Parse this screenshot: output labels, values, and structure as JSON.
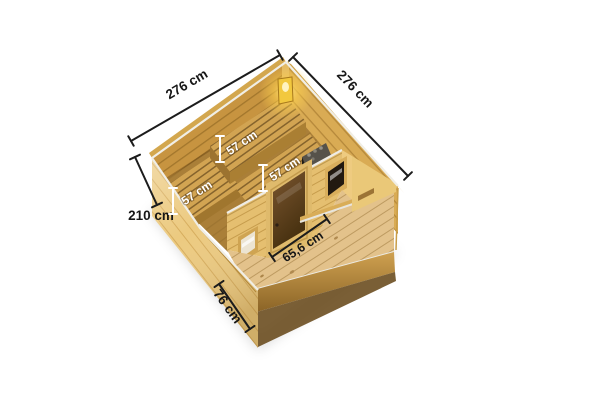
{
  "image": {
    "type": "product-dimension-diagram",
    "subject": "wooden sauna cabin, isometric top view with open roof, measurement annotations"
  },
  "dimensions": {
    "edge_top_left": {
      "label": "276 cm"
    },
    "edge_top_right": {
      "label": "276 cm"
    },
    "wall_height": {
      "label": "210 cm"
    },
    "porch_depth": {
      "label": "76 cm"
    },
    "door_width": {
      "label": "65,6 cm"
    },
    "bench_back": {
      "label": "57 cm"
    },
    "bench_middle": {
      "label": "57 cm"
    },
    "bench_front": {
      "label": "57 cm"
    }
  },
  "colors": {
    "background": "#ffffff",
    "wood_exterior": "#ecca80",
    "wood_interior_wall": "#c79440",
    "wood_bench_slats": "#d2a452",
    "slat_gap": "#85632c",
    "wood_deck": "#e3c28b",
    "edge_cap_silver": "#f0eee6",
    "dimension_line": "#1c1c1c",
    "dimension_text_dark": "#161616",
    "dimension_text_light": "#ffffff",
    "door_glass": "#5e3f20",
    "lamp_glow": "#ffd966",
    "heater_body": "#262420",
    "shadow": "rgba(0,0,0,0.16)"
  }
}
